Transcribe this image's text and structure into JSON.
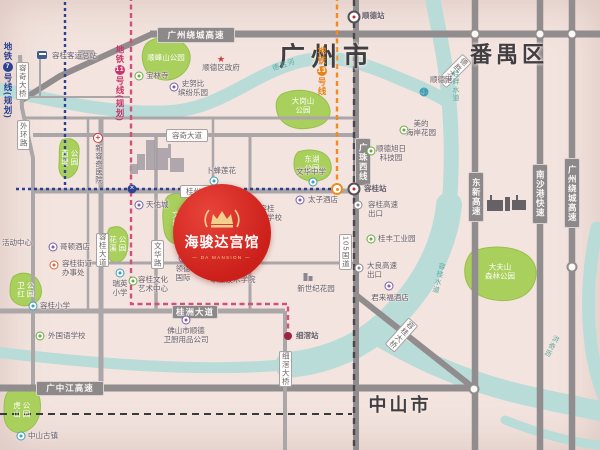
{
  "regions": [
    {
      "text": "广州市",
      "x": 327,
      "y": 55,
      "size": 26,
      "ls": 6
    },
    {
      "text": "番禺区",
      "x": 509,
      "y": 53,
      "size": 22,
      "ls": 4
    },
    {
      "text": "中山市",
      "x": 400,
      "y": 404,
      "size": 18,
      "ls": 3
    }
  ],
  "badge": {
    "title": "海骏达宫馆",
    "subtitle": "— DA MANSION —",
    "cx": 222,
    "cy": 233,
    "r": 49
  },
  "colors": {
    "bg": "#f3e4df",
    "road": "#aba6a7",
    "highway": "#918c8d",
    "river": "#b9dcd9",
    "park": "#a9cf5d",
    "park_border": "#98bf4c",
    "rail": "#4a464c",
    "boundary": "#3d3a3e",
    "navy": "#2c4190",
    "pink": "#d4507c",
    "orange": "#ef8b1f",
    "badge_red": "#cb1f1a",
    "gold": "#f3cf8d"
  },
  "metro_labels": [
    {
      "prefix": "地铁",
      "num": "7",
      "suffix": "号线(规划)",
      "x": 2,
      "y": 42,
      "color": "#2c4190"
    },
    {
      "prefix": "地铁",
      "num": "11",
      "suffix": "号线(规划)",
      "x": 114,
      "y": 45,
      "color": "#c9356b"
    },
    {
      "prefix": "地铁",
      "num": "13",
      "suffix": "号线",
      "x": 316,
      "y": 46,
      "color": "#e8821a"
    }
  ],
  "road_labels": [
    {
      "t": "广州绕城高速",
      "x": 157,
      "y": 27,
      "w": 76,
      "h": 14,
      "kind": "hw"
    },
    {
      "t": "广中江高速",
      "x": 36,
      "y": 381,
      "w": 66,
      "h": 13,
      "kind": "hw"
    },
    {
      "t": "桂洲大道",
      "x": 172,
      "y": 305,
      "w": 44,
      "h": 12,
      "kind": "hw"
    },
    {
      "t": "广珠西线",
      "x": 355,
      "y": 138,
      "w": 14,
      "h": 46,
      "kind": "hw",
      "vert": 1
    },
    {
      "t": "东新高速",
      "x": 468,
      "y": 172,
      "w": 14,
      "h": 48,
      "kind": "hw",
      "vert": 1
    },
    {
      "t": "南沙港快速",
      "x": 532,
      "y": 164,
      "w": 14,
      "h": 58,
      "kind": "hw",
      "vert": 1
    },
    {
      "t": "广州绕城高速",
      "x": 564,
      "y": 158,
      "w": 14,
      "h": 68,
      "kind": "hw",
      "vert": 1
    },
    {
      "t": "容奇大道",
      "x": 166,
      "y": 129,
      "w": 40,
      "h": 11,
      "kind": "st"
    },
    {
      "t": "桂州大道",
      "x": 180,
      "y": 185,
      "w": 40,
      "h": 11,
      "kind": "st"
    },
    {
      "t": "容桂大道",
      "x": 96,
      "y": 233,
      "w": 11,
      "h": 32,
      "kind": "st",
      "vert": 1
    },
    {
      "t": "文华路",
      "x": 151,
      "y": 240,
      "w": 11,
      "h": 27,
      "kind": "st",
      "vert": 1
    },
    {
      "t": "105国道",
      "x": 339,
      "y": 234,
      "w": 11,
      "h": 34,
      "kind": "st",
      "vert": 1
    },
    {
      "t": "容奇大桥",
      "x": 16,
      "y": 62,
      "w": 11,
      "h": 36,
      "kind": "st",
      "vert": 1
    },
    {
      "t": "外环路",
      "x": 17,
      "y": 120,
      "w": 11,
      "h": 28,
      "kind": "st",
      "vert": 1
    },
    {
      "t": "细滘大桥",
      "x": 279,
      "y": 351,
      "w": 11,
      "h": 34,
      "kind": "st",
      "vert": 1
    },
    {
      "t": "容桂大桥",
      "x": 395,
      "y": 317,
      "w": 11,
      "h": 34,
      "kind": "st",
      "vert": 1,
      "rot": 42
    },
    {
      "t": "德胜大桥",
      "x": 448,
      "y": 53,
      "w": 11,
      "h": 34,
      "kind": "st",
      "vert": 1,
      "rot": 45
    }
  ],
  "stations": [
    {
      "t": "顺德站",
      "x": 354,
      "y": 17,
      "k": "rail",
      "lx": 362,
      "ly": 12
    },
    {
      "t": "容桂站",
      "x": 354,
      "y": 189,
      "k": "rail",
      "lx": 364,
      "ly": 185
    },
    {
      "t": "细滘站",
      "x": 288,
      "y": 336,
      "k": "pink-term",
      "lx": 296,
      "ly": 332
    },
    {
      "t": "",
      "x": 132,
      "y": 189,
      "k": "navy-inter"
    },
    {
      "t": "",
      "x": 337,
      "y": 189,
      "k": "orange-term"
    }
  ],
  "parks": [
    {
      "id": "shunfengshan",
      "rows": [
        "顺峰山公园"
      ],
      "cx": 166,
      "cy": 58
    },
    {
      "id": "dagangshan",
      "rows": [
        "大岗山",
        "公园"
      ],
      "cx": 303,
      "cy": 106
    },
    {
      "id": "donghu",
      "rows": [
        "东湖",
        "公园"
      ],
      "cx": 312,
      "cy": 164
    },
    {
      "id": "dafushan",
      "rows": [
        "大夫山",
        "森林公园"
      ],
      "cx": 500,
      "cy": 272
    },
    {
      "id": "xidi",
      "cols": [
        "西堤",
        "公园"
      ],
      "cx": 69,
      "cy": 158
    },
    {
      "id": "wenta",
      "cols": [
        "文塔",
        "公园"
      ],
      "cx": 180,
      "cy": 219
    },
    {
      "id": "huaxi",
      "cols": [
        "花溪",
        "公园"
      ],
      "cx": 117,
      "cy": 244
    },
    {
      "id": "weihong",
      "cols": [
        "卫红",
        "公园"
      ],
      "cx": 25,
      "cy": 290
    },
    {
      "id": "hushan",
      "cols": [
        "虎山",
        "公园"
      ],
      "cx": 21,
      "cy": 410
    }
  ],
  "pois": [
    {
      "t": [
        "容桂客运总站"
      ],
      "x": 52,
      "y": 52,
      "a": "l",
      "icon": {
        "k": "bus",
        "c": "#3f5d8f",
        "x": 42,
        "y": 55
      }
    },
    {
      "t": [
        "宝林寺"
      ],
      "x": 146,
      "y": 72,
      "a": "l",
      "icon": {
        "k": "dot",
        "c": "#6aaa3f",
        "x": 139,
        "y": 76
      }
    },
    {
      "t": [
        "史努比",
        "缤纷乐园"
      ],
      "x": 193,
      "y": 80,
      "a": "c",
      "icon": {
        "k": "dot",
        "c": "#7b5ea7",
        "x": 174,
        "y": 87
      }
    },
    {
      "t": [
        "顺德区政府"
      ],
      "x": 221,
      "y": 64,
      "a": "c",
      "icon": {
        "k": "star",
        "c": "#d23b3b",
        "x": 221,
        "y": 58
      }
    },
    {
      "t": [
        "顺德港"
      ],
      "x": 430,
      "y": 76,
      "a": "l",
      "icon": {
        "k": "anchor",
        "c": "#3f9fb8",
        "x": 424,
        "y": 92
      }
    },
    {
      "t": [
        "美的",
        "海岸花园"
      ],
      "x": 421,
      "y": 120,
      "a": "c",
      "icon": {
        "k": "dot",
        "c": "#6aaa3f",
        "x": 404,
        "y": 130
      }
    },
    {
      "t": [
        "新容奇医院"
      ],
      "x": 94,
      "y": 144,
      "a": "l",
      "vert": 1,
      "icon": {
        "k": "cross",
        "c": "#d23b3b",
        "x": 98,
        "y": 138
      }
    },
    {
      "t": [
        "卜蜂莲花"
      ],
      "x": 206,
      "y": 167,
      "a": "l",
      "icon": {
        "k": "dot",
        "c": "#3f9fb8",
        "x": 214,
        "y": 181
      }
    },
    {
      "t": [
        "文华中学"
      ],
      "x": 296,
      "y": 168,
      "a": "l",
      "icon": {
        "k": "dot",
        "c": "#3f9fb8",
        "x": 313,
        "y": 182
      }
    },
    {
      "t": [
        "顺德旭日",
        "科技园"
      ],
      "x": 391,
      "y": 145,
      "a": "c",
      "icon": {
        "k": "dot",
        "c": "#6aaa3f",
        "x": 371,
        "y": 151
      }
    },
    {
      "t": [
        "太子酒店"
      ],
      "x": 308,
      "y": 196,
      "a": "l",
      "icon": {
        "k": "dot",
        "c": "#7b5ea7",
        "x": 300,
        "y": 200
      }
    },
    {
      "t": [
        "容桂",
        "实验学校"
      ],
      "x": 267,
      "y": 205,
      "a": "c",
      "icon": {
        "k": "dot",
        "c": "#3f9fb8",
        "x": 248,
        "y": 210
      }
    },
    {
      "t": [
        "桂丰工业园"
      ],
      "x": 378,
      "y": 235,
      "a": "l",
      "icon": {
        "k": "dot",
        "c": "#6aaa3f",
        "x": 371,
        "y": 239
      }
    },
    {
      "t": [
        "容桂高速",
        "出口"
      ],
      "x": 368,
      "y": 201,
      "a": "l",
      "icon": {
        "k": "exit",
        "c": "#8d8889",
        "x": 358,
        "y": 205
      }
    },
    {
      "t": [
        "大良高速",
        "出口"
      ],
      "x": 367,
      "y": 262,
      "a": "l",
      "icon": {
        "k": "exit",
        "c": "#8d8889",
        "x": 359,
        "y": 268
      }
    },
    {
      "t": [
        "君来福酒店"
      ],
      "x": 390,
      "y": 294,
      "a": "c",
      "icon": {
        "k": "dot",
        "c": "#7b5ea7",
        "x": 389,
        "y": 286
      }
    },
    {
      "t": [
        "天佑城"
      ],
      "x": 146,
      "y": 201,
      "a": "l",
      "icon": {
        "k": "dot",
        "c": "#7b5ea7",
        "x": 139,
        "y": 205
      }
    },
    {
      "t": [
        "哥顿酒店"
      ],
      "x": 60,
      "y": 243,
      "a": "l",
      "icon": {
        "k": "dot",
        "c": "#7b5ea7",
        "x": 53,
        "y": 247
      }
    },
    {
      "t": [
        "容桂街道",
        "办事处"
      ],
      "x": 62,
      "y": 260,
      "a": "l",
      "icon": {
        "k": "dot",
        "c": "#d9663c",
        "x": 54,
        "y": 265
      }
    },
    {
      "t": [
        "活动中心"
      ],
      "x": 2,
      "y": 239,
      "a": "l"
    },
    {
      "t": [
        "瑞英",
        "小学"
      ],
      "x": 120,
      "y": 280,
      "a": "c",
      "icon": {
        "k": "dot",
        "c": "#3f9fb8",
        "x": 120,
        "y": 273
      }
    },
    {
      "t": [
        "容桂文化",
        "艺术中心"
      ],
      "x": 153,
      "y": 276,
      "a": "c",
      "icon": {
        "k": "dot",
        "c": "#6aaa3f",
        "x": 133,
        "y": 281
      }
    },
    {
      "t": [
        "领德",
        "国际"
      ],
      "x": 183,
      "y": 265,
      "a": "c",
      "icon": {
        "k": "dot",
        "c": "#7b5ea7",
        "x": 183,
        "y": 258
      }
    },
    {
      "t": [
        "胡锦超",
        "职业技术学院"
      ],
      "x": 233,
      "y": 267,
      "a": "c"
    },
    {
      "t": [
        "新世纪花园"
      ],
      "x": 316,
      "y": 285,
      "a": "c",
      "icon": {
        "k": "bldg",
        "c": "#8a8590",
        "x": 308,
        "y": 277
      }
    },
    {
      "t": [
        "容桂小学"
      ],
      "x": 40,
      "y": 302,
      "a": "l",
      "icon": {
        "k": "dot",
        "c": "#3f9fb8",
        "x": 33,
        "y": 306
      }
    },
    {
      "t": [
        "外国语学校"
      ],
      "x": 48,
      "y": 332,
      "a": "l",
      "icon": {
        "k": "dot",
        "c": "#6aaa3f",
        "x": 40,
        "y": 336
      }
    },
    {
      "t": [
        "佛山市顺德",
        "卫厨用品公司"
      ],
      "x": 186,
      "y": 327,
      "a": "c",
      "icon": {
        "k": "dot",
        "c": "#7b5ea7",
        "x": 186,
        "y": 320
      }
    },
    {
      "t": [
        "中山古镇"
      ],
      "x": 28,
      "y": 432,
      "a": "l",
      "icon": {
        "k": "dot",
        "c": "#3f9fb8",
        "x": 21,
        "y": 436
      }
    }
  ],
  "river_labels": [
    {
      "t": "德胜河",
      "x": 272,
      "y": 60,
      "rot": -18
    },
    {
      "t": "桂畔水道",
      "x": 450,
      "y": 70,
      "vert": 1
    },
    {
      "t": "容桂水道",
      "x": 433,
      "y": 262,
      "vert": 1,
      "rot": 14
    },
    {
      "t": "洪奇沥",
      "x": 546,
      "y": 334,
      "vert": 1,
      "rot": 28
    }
  ]
}
